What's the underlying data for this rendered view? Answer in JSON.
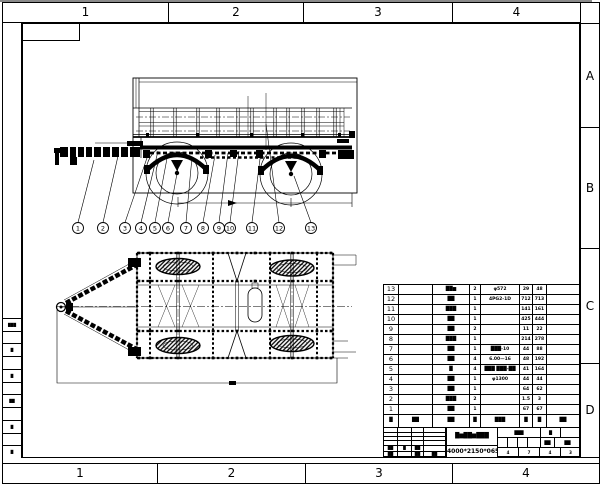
{
  "sheet": {
    "top_zones": [
      "1",
      "2",
      "3",
      "4"
    ],
    "bottom_zones": [
      "1",
      "2",
      "3",
      "4"
    ],
    "row_zones": [
      "A",
      "B",
      "C",
      "D"
    ]
  },
  "left_margin_cells": [
    "███",
    "",
    "█",
    "",
    "█",
    "",
    "██",
    "",
    "█",
    "",
    "█"
  ],
  "callouts": [
    {
      "n": "1",
      "x": 78,
      "tx": 94,
      "ty": 160
    },
    {
      "n": "2",
      "x": 103,
      "tx": 118,
      "ty": 156
    },
    {
      "n": "3",
      "x": 125,
      "tx": 149,
      "ty": 152
    },
    {
      "n": "4",
      "x": 141,
      "tx": 158,
      "ty": 151
    },
    {
      "n": "5",
      "x": 155,
      "tx": 168,
      "ty": 153
    },
    {
      "n": "6",
      "x": 168,
      "tx": 178,
      "ty": 168
    },
    {
      "n": "7",
      "x": 186,
      "tx": 192,
      "ty": 157
    },
    {
      "n": "8",
      "x": 203,
      "tx": 215,
      "ty": 155
    },
    {
      "n": "9",
      "x": 219,
      "tx": 228,
      "ty": 153
    },
    {
      "n": "10",
      "x": 230,
      "tx": 239,
      "ty": 151
    },
    {
      "n": "11",
      "x": 252,
      "tx": 261,
      "ty": 151
    },
    {
      "n": "12",
      "x": 279,
      "tx": 266,
      "ty": 124
    },
    {
      "n": "13",
      "x": 311,
      "tx": 294,
      "ty": 176
    }
  ],
  "parts_table": {
    "header": {
      "no": "█",
      "code": "██",
      "name": "██",
      "qty": "█",
      "spec": "███",
      "w1": "█",
      "w2": "█",
      "rem": "██"
    },
    "rows": [
      {
        "no": "13",
        "code": "",
        "name": "██▆",
        "qty": "2",
        "spec": "φ572",
        "w1": "29",
        "w2": "48",
        "rem": ""
      },
      {
        "no": "12",
        "code": "",
        "name": "██",
        "qty": "1",
        "spec": "4PG2-1D",
        "w1": "712",
        "w2": "713",
        "rem": ""
      },
      {
        "no": "11",
        "code": "",
        "name": "███",
        "qty": "1",
        "spec": "",
        "w1": "141",
        "w2": "161",
        "rem": ""
      },
      {
        "no": "10",
        "code": "",
        "name": "██",
        "qty": "1",
        "spec": "",
        "w1": "425",
        "w2": "444",
        "rem": ""
      },
      {
        "no": "9",
        "code": "",
        "name": "██",
        "qty": "2",
        "spec": "",
        "w1": "11",
        "w2": "22",
        "rem": ""
      },
      {
        "no": "8",
        "code": "",
        "name": "███",
        "qty": "1",
        "spec": "",
        "w1": "214",
        "w2": "278",
        "rem": ""
      },
      {
        "no": "7",
        "code": "",
        "name": "██",
        "qty": "1",
        "spec": "███-10",
        "w1": "44",
        "w2": "88",
        "rem": ""
      },
      {
        "no": "6",
        "code": "",
        "name": "██",
        "qty": "4",
        "spec": "6.00—16",
        "w1": "48",
        "w2": "192",
        "rem": ""
      },
      {
        "no": "5",
        "code": "",
        "name": "█",
        "qty": "4",
        "spec": "███ ███-██",
        "w1": "41",
        "w2": "164",
        "rem": ""
      },
      {
        "no": "4",
        "code": "",
        "name": "██",
        "qty": "1",
        "spec": "φ1300",
        "w1": "44",
        "w2": "44",
        "rem": ""
      },
      {
        "no": "3",
        "code": "",
        "name": "██",
        "qty": "1",
        "spec": "",
        "w1": "64",
        "w2": "62",
        "rem": ""
      },
      {
        "no": "2",
        "code": "",
        "name": "███",
        "qty": "2",
        "spec": "",
        "w1": "1.5",
        "w2": "3",
        "rem": ""
      },
      {
        "no": "1",
        "code": "",
        "name": "██",
        "qty": "1",
        "spec": "",
        "w1": "67",
        "w2": "67",
        "rem": ""
      }
    ]
  },
  "title_block": {
    "title": "█▆██▆███",
    "size_text": "4000*2150*065",
    "left_grid": [
      [
        "",
        "",
        "",
        ""
      ],
      [
        "",
        "",
        "",
        ""
      ],
      [
        "",
        "",
        "",
        ""
      ],
      [
        "",
        "",
        "",
        ""
      ],
      [
        "██",
        "█",
        "██",
        ""
      ],
      [
        "██",
        "",
        "██",
        "██"
      ]
    ],
    "right_grid": [
      [
        "███",
        "█",
        ""
      ],
      [
        "",
        "",
        "",
        "",
        "██",
        "██"
      ],
      [
        "4",
        "7",
        "4",
        "3"
      ]
    ]
  }
}
